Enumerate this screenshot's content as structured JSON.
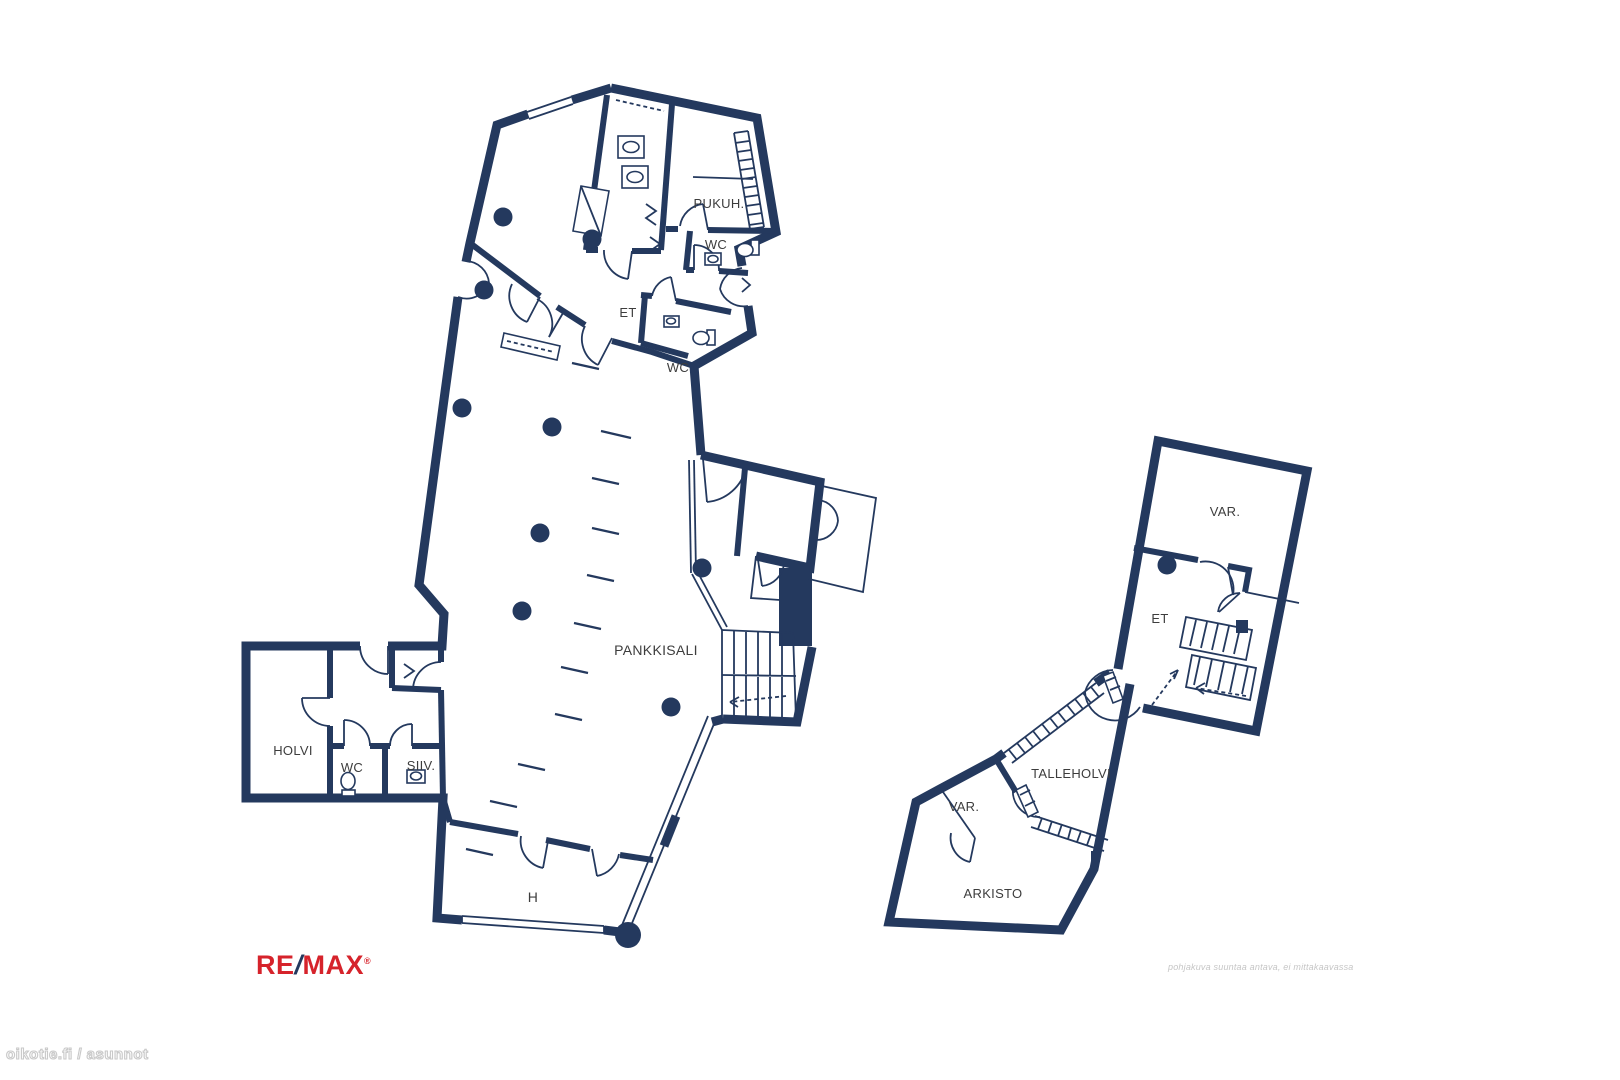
{
  "floorplan": {
    "labels": {
      "pukuh": "PUKUH.",
      "wc_top": "WC",
      "et_main": "ET",
      "wc_mid": "WC",
      "pankkisali": "PANKKISALI",
      "holvi": "HOLVI",
      "wc_annex": "WC",
      "siiv": "SIIV.",
      "h": "H",
      "var_upper": "VAR.",
      "et_right": "ET",
      "talleholvi": "TALLEHOLVI",
      "var_lower": "VAR.",
      "arkisto": "ARKISTO"
    },
    "disclaimer": "pohjakuva suuntaa antava, ei mittakaavassa",
    "watermark": "oikotie.fi / asunnot",
    "logo": {
      "re": "RE",
      "slash": "/",
      "max": "MAX",
      "reg": "®"
    },
    "colors": {
      "wall": "#24395e",
      "label": "#3d3d3d",
      "logo-red": "#d6232b"
    }
  }
}
